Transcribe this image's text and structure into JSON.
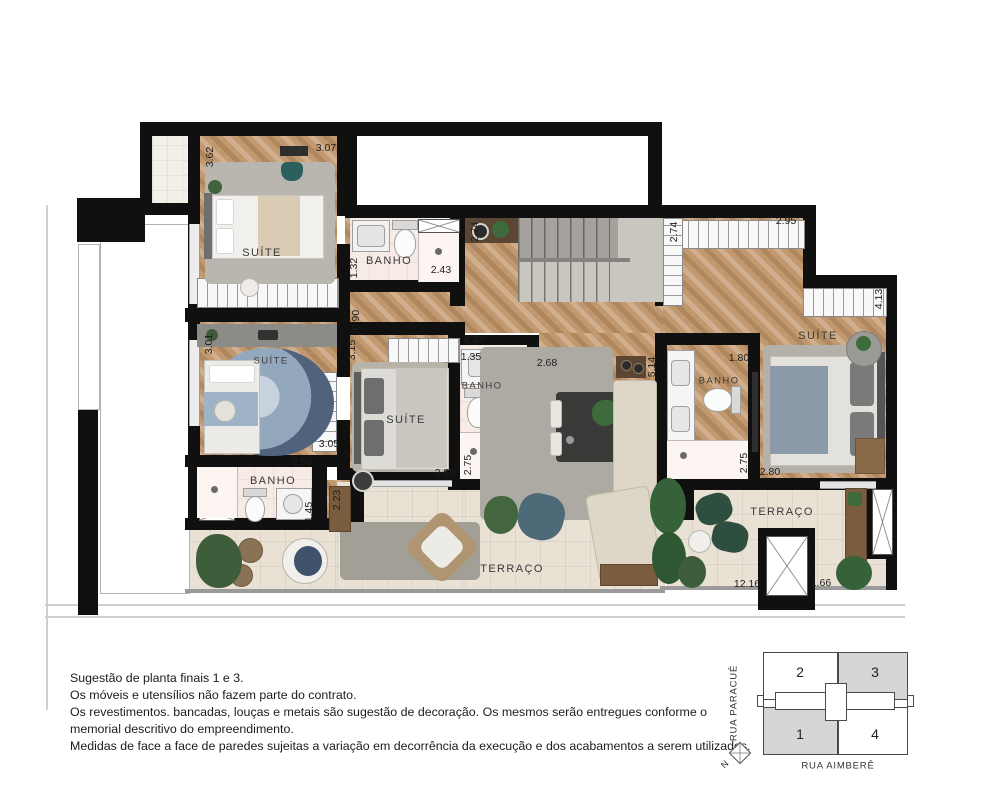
{
  "rooms": {
    "suite1": "SUÍTE",
    "banho1": "BANHO",
    "suite2": "SUÍTE",
    "suite3": "SUÍTE",
    "banho2": "BANHO",
    "banho4": "BANHO",
    "suite4": "SUÍTE",
    "banho3": "BANHO",
    "terraco1": "TERRAÇO",
    "terraco2": "TERRAÇO"
  },
  "dims": {
    "h": [
      "3.07",
      "2.43",
      "2.95",
      "4.37",
      "1.35",
      "2.68",
      "1.80",
      "3.05",
      "2.50",
      "2.50",
      "2.80",
      "12.16",
      "1.66"
    ],
    "v": [
      "3.62",
      "1.32",
      "2.74",
      "2.74",
      "4.13",
      "0.90",
      "3.01",
      "3.15",
      "5.14",
      "2.75",
      "2.75",
      "1.45",
      "2.23"
    ]
  },
  "notes": {
    "lines": [
      "Sugestão de planta finais 1 e 3.",
      "Os móveis e utensílios não fazem parte do contrato.",
      "Os revestimentos. bancadas, louças e metais são sugestão de decoração. Os mesmos serão entregues conforme o",
      "memorial descritivo do empreendimento.",
      "Medidas de face a face de paredes sujeitas a variação em decorrência da execução e dos acabamentos a serem utilizados."
    ]
  },
  "keyplan": {
    "units": [
      "2",
      "3",
      "1",
      "4"
    ],
    "street_left": "RUA PARACUÊ",
    "street_bottom": "RUA AIMBERÊ",
    "north": "N",
    "highlight_color": "#d6d6d6",
    "highlighted_units": "1 e 3"
  },
  "colors": {
    "wall": "#101010",
    "wood_floor": "#c2996e",
    "bath_floor": "#f7ebe6",
    "terrace_tile": "#eae1d5",
    "keyplan_gray": "#d6d6d6"
  }
}
